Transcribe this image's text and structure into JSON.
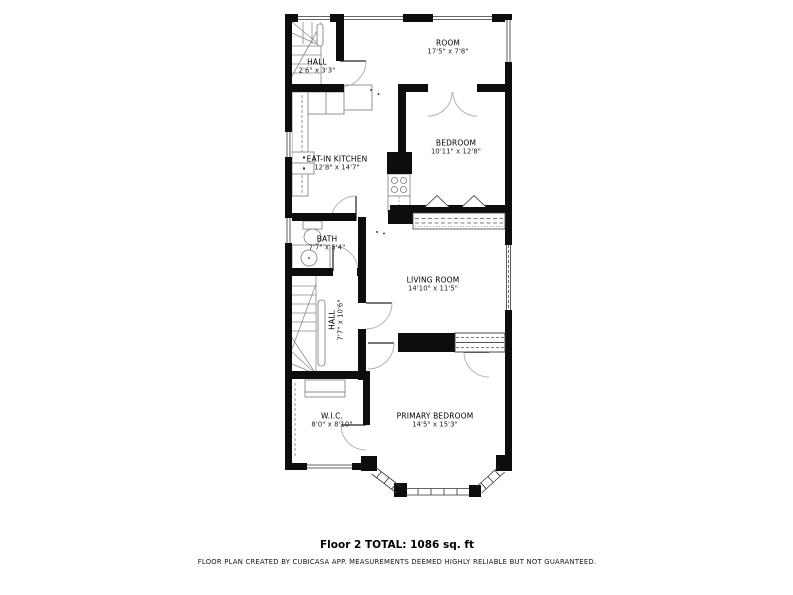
{
  "plan": {
    "rooms": [
      {
        "id": "hall-upper",
        "name": "HALL",
        "dims": "2'6\" x 3'3\""
      },
      {
        "id": "room",
        "name": "ROOM",
        "dims": "17'5\" x 7'8\""
      },
      {
        "id": "eat-in-kitchen",
        "name": "EAT-IN KITCHEN",
        "dims": "12'8\" x 14'7\""
      },
      {
        "id": "bedroom",
        "name": "BEDROOM",
        "dims": "10'11\" x 12'8\""
      },
      {
        "id": "bath",
        "name": "BATH",
        "dims": "7'7\" x 5'4\""
      },
      {
        "id": "living-room",
        "name": "LIVING ROOM",
        "dims": "14'10\" x 11'5\""
      },
      {
        "id": "hall-lower",
        "name": "HALL",
        "dims": "7'7\" x 10'6\""
      },
      {
        "id": "wic",
        "name": "W.I.C.",
        "dims": "8'0\" x 8'10\""
      },
      {
        "id": "primary-bedroom",
        "name": "PRIMARY BEDROOM",
        "dims": "14'5\" x 15'3\""
      }
    ],
    "footer": {
      "total": "Floor 2 TOTAL: 1086 sq. ft",
      "disclaimer": "FLOOR PLAN CREATED BY CUBICASA APP. MEASUREMENTS DEEMED HIGHLY RELIABLE BUT NOT GUARANTEED."
    },
    "colors": {
      "wall": "#0d0d0d",
      "thin_line": "#888888",
      "door_arc": "#b3b3b3",
      "background": "#ffffff"
    }
  }
}
